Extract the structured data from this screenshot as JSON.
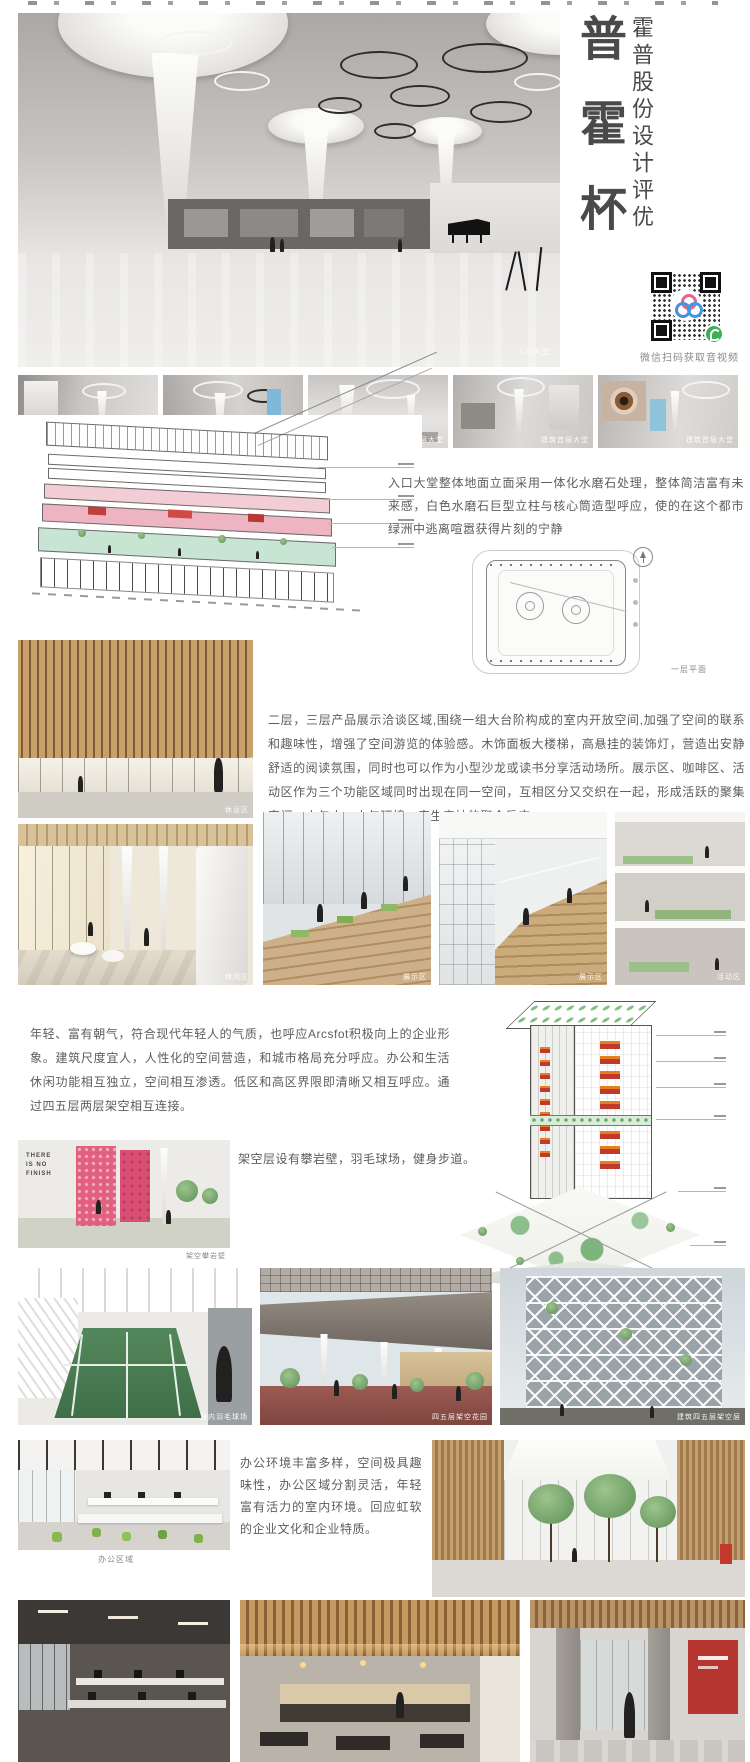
{
  "header": {
    "title_vertical": "普霍杯",
    "subtitle_vertical": "霍普股份设计评优",
    "qr_caption": "微信扫码获取音视频"
  },
  "hero": {
    "caption": "入口大堂"
  },
  "thumbnails": [
    {
      "caption": "建筑首层大堂"
    },
    {
      "caption": "建筑首层大堂"
    },
    {
      "caption": "建筑首层大堂"
    },
    {
      "caption": "建筑首层大堂"
    },
    {
      "caption": "建筑首层大堂"
    }
  ],
  "section_lobby": {
    "paragraph": "入口大堂整体地面立面采用一体化水磨石处理，整体简洁富有未来感，白色水磨石巨型立柱与核心筒造型呼应，使的在这个都市绿洲中逃离喧嚣获得片刻的宁静",
    "plan_caption": "一层平面"
  },
  "section_display": {
    "paragraph": "二层，三层产品展示洽谈区域,围绕一组大台阶构成的室内开放空间,加强了空间的联系和趣味性，增强了空间游览的体验感。木饰面板大楼梯，高悬挂的装饰灯，营造出安静舒适的阅读氛围，同时也可以作为小型沙龙或读书分享活动场所。展示区、咖啡区、活动区作为三个功能区域同时出现在同一空间，互相区分又交织在一起，形成活跃的聚集空间，人与人、人与环境，产生奇妙的聚合反应。",
    "captions": {
      "rest": "休息区",
      "leisure": "休闲区",
      "display1": "展示区",
      "display2": "展示区",
      "activity": "活动区"
    }
  },
  "section_tower": {
    "paragraph": "年轻、富有朝气，符合现代年轻人的气质，也呼应Arcsfot积极向上的企业形象。建筑尺度宜人，人性化的空间营造，和城市格局充分呼应。办公和生活休闲功能相互独立，空间相互渗透。低区和高区界限即清晰又相互呼应。通过四五层两层架空相互连接。",
    "note": "架空层设有攀岩壁，羽毛球场，健身步道。",
    "climb_wall_text": "THERE IS NO FINISH",
    "captions": {
      "climb": "架空攀岩壁",
      "badminton": "室内羽毛球场",
      "terrace": "四五层架空花园",
      "lattice": "建筑四五层架空层"
    }
  },
  "section_office": {
    "paragraph": "办公环境丰富多样，空间极具趣味性，办公区域分割灵活，年轻富有活力的室内环境。回应虹软的企业文化和企业特质。",
    "captions": {
      "office": "办公区域"
    }
  }
}
